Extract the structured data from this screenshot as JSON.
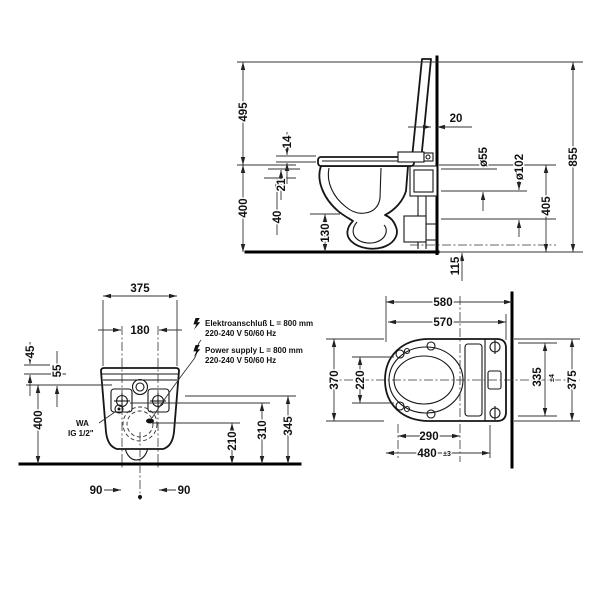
{
  "side_view": {
    "d495": "495",
    "d14": "14",
    "d21": "21",
    "d40": "40",
    "d400": "400",
    "d130": "130",
    "d20": "20",
    "d55": "ø55",
    "d102": "ø102",
    "d405": "405",
    "d855": "855",
    "d115": "115"
  },
  "back_view": {
    "d375": "375",
    "d180": "180",
    "d45": "45",
    "d55": "55",
    "d400": "400",
    "d90_left": "90",
    "d90_right": "90",
    "d210": "210",
    "d310": "310",
    "d345": "345",
    "wa_line1": "WA",
    "wa_line2": "IG 1/2\"",
    "power_de_1": "Elektroanschluß L = 800 mm",
    "power_de_2": "220-240 V 50/60 Hz",
    "power_en_1": "Power supply L = 800 mm",
    "power_en_2": "220-240 V 50/60 Hz"
  },
  "top_view": {
    "d580": "580",
    "d570": "570",
    "d370": "370",
    "d220": "220",
    "d335": "335",
    "d335_tol": "±4",
    "d375": "375",
    "d290": "290",
    "d480": "480",
    "d480_tol": "±3"
  },
  "icons": {
    "power": "lightning-bolt"
  },
  "colors": {
    "line": "#161616",
    "dimension": "#333333",
    "text": "#111111",
    "background": "#ffffff"
  }
}
